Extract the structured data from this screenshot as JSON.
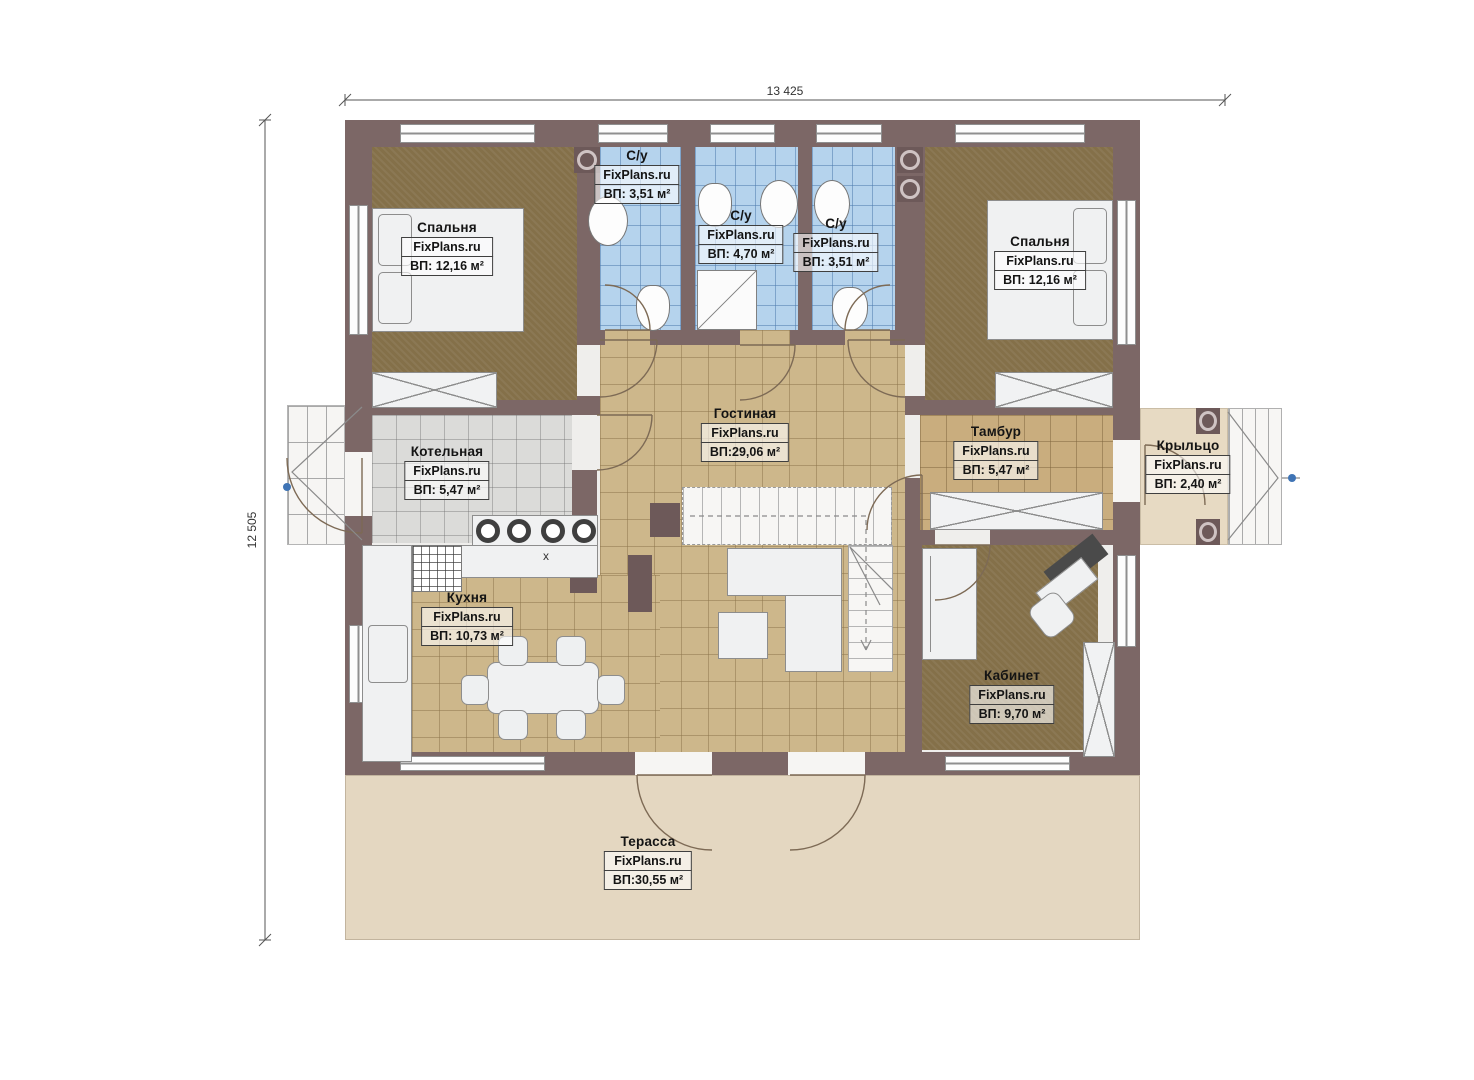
{
  "brand": "FixPlans.ru",
  "dimensions": {
    "top": "13 425",
    "left": "12 505"
  },
  "rooms": [
    {
      "id": "bedroom-left",
      "name": "Спальня",
      "brand": "FixPlans.ru",
      "area": "ВП: 12,16 м²"
    },
    {
      "id": "bath-1",
      "name": "С/у",
      "brand": "FixPlans.ru",
      "area": "ВП: 3,51 м²"
    },
    {
      "id": "bath-2",
      "name": "С/у",
      "brand": "FixPlans.ru",
      "area": "ВП: 4,70 м²"
    },
    {
      "id": "bath-3",
      "name": "С/у",
      "brand": "FixPlans.ru",
      "area": "ВП: 3,51 м²"
    },
    {
      "id": "bedroom-right",
      "name": "Спальня",
      "brand": "FixPlans.ru",
      "area": "ВП: 12,16 м²"
    },
    {
      "id": "boiler",
      "name": "Котельная",
      "brand": "FixPlans.ru",
      "area": "ВП: 5,47 м²"
    },
    {
      "id": "living",
      "name": "Гостиная",
      "brand": "FixPlans.ru",
      "area": "ВП:29,06 м²"
    },
    {
      "id": "vestibule",
      "name": "Тамбур",
      "brand": "FixPlans.ru",
      "area": "ВП: 5,47 м²"
    },
    {
      "id": "porch",
      "name": "Крыльцо",
      "brand": "FixPlans.ru",
      "area": "ВП: 2,40 м²"
    },
    {
      "id": "kitchen",
      "name": "Кухня",
      "brand": "FixPlans.ru",
      "area": "ВП: 10,73 м²"
    },
    {
      "id": "office",
      "name": "Кабинет",
      "brand": "FixPlans.ru",
      "area": "ВП: 9,70 м²"
    },
    {
      "id": "terrace",
      "name": "Терасса",
      "brand": "FixPlans.ru",
      "area": "ВП:30,55 м²"
    }
  ],
  "misc": {
    "counter_mark": "x"
  },
  "colors": {
    "wall": "#7c6766",
    "bedroomFloor": "#847049",
    "bathFloor": "#b5d3ed",
    "livingFloor": "#cdb78b",
    "vestibuleFloor": "#c9ad7e",
    "boilerFloor": "#dbdbd9",
    "terraceFloor": "#e4d7c1",
    "porchFloor": "#e7dac3"
  }
}
